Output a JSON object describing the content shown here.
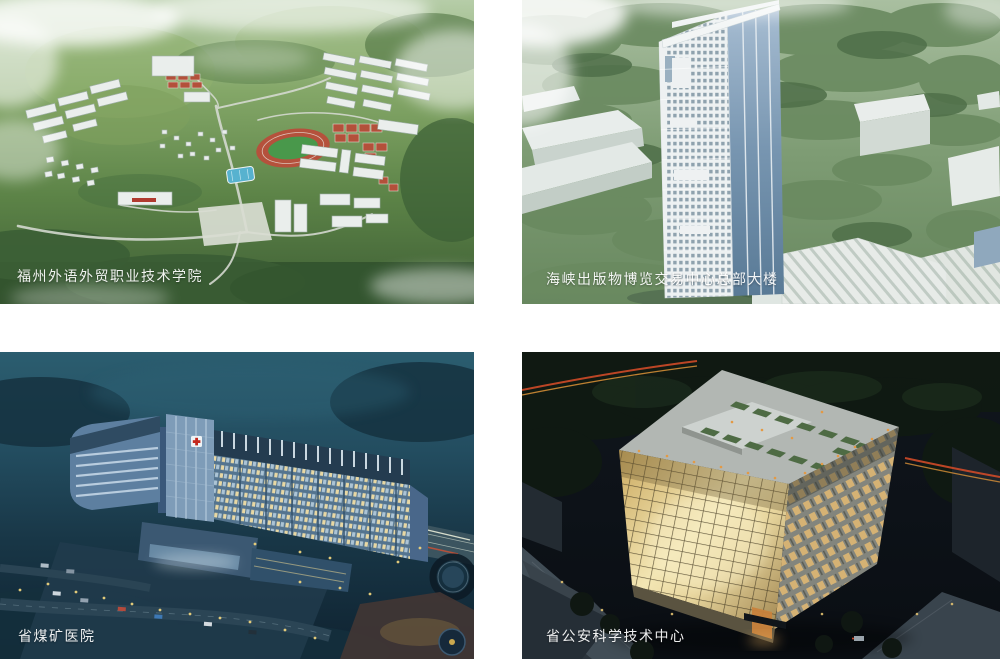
{
  "projects": [
    {
      "id": "campus",
      "caption": "福州外语外贸职业技术学院"
    },
    {
      "id": "tower",
      "caption": "海峡出版物博览交易中心总部大楼"
    },
    {
      "id": "hospital",
      "caption": "省煤矿医院"
    },
    {
      "id": "tech",
      "caption": "省公安科学技术中心"
    }
  ],
  "palette": {
    "page_background": "#ffffff",
    "caption_color": "#ffffff",
    "campus_green": "#6f9a55",
    "tower_glass_blue": "#7795b0",
    "hospital_night_teal": "#234d60",
    "tech_window_glow": "#ead9a2"
  }
}
